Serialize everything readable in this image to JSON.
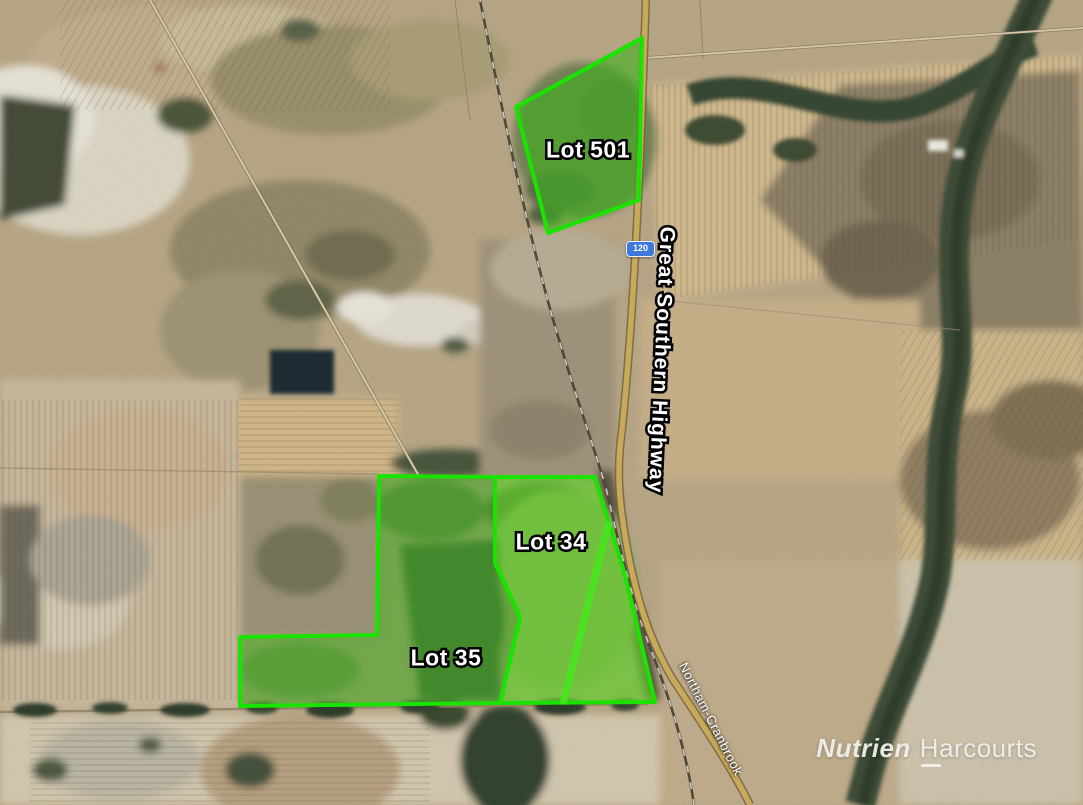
{
  "map": {
    "highway": {
      "name": "Great Southern Highway",
      "route_number": "120"
    },
    "road": {
      "name": "Northam-Cranbrook"
    },
    "lots": [
      {
        "name": "Lot 501",
        "label": {
          "x": 588,
          "y": 150
        },
        "points": "642,38 516,107 548,233 639,200",
        "fill": "#3fae1f",
        "fill_opacity": 0.62
      },
      {
        "name": "Lot 34",
        "label": {
          "x": 551,
          "y": 542
        },
        "points": "495,477 595,477 625,575 655,702 500,703 520,617 495,563",
        "fill": "#55d122",
        "fill_opacity": 0.62,
        "track": "609,522 563,704"
      },
      {
        "name": "Lot 35",
        "label": {
          "x": 446,
          "y": 658
        },
        "points": "379,476 495,477 495,563 520,617 500,703 240,706 240,637 377,635",
        "fill": "#3ba61e",
        "fill_opacity": 0.55
      }
    ],
    "branding": {
      "primary": "Nutrien",
      "secondary": "Harcourts"
    },
    "colors": {
      "lot_border": "#17e400",
      "lot_track": "#45e51c",
      "shield_background": "#3e78dc",
      "shield_text": "#ffffff",
      "label_text": "#ffffff",
      "label_outline": "#000000"
    }
  }
}
